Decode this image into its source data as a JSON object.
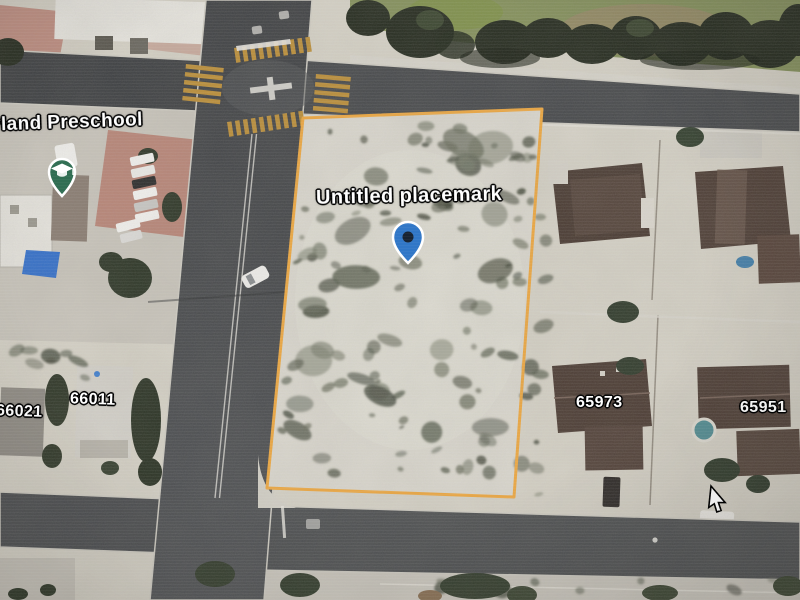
{
  "view": {
    "description": "aerial satellite view with a highlighted vacant parcel"
  },
  "labels": {
    "preschool": "yland Preschool",
    "placemark": "Untitled placemark",
    "parcels": {
      "h66021": "66021",
      "h66011": "66011",
      "h65973": "65973",
      "h65951": "65951"
    }
  },
  "icons": {
    "education_pin": "graduation-cap-pin-icon",
    "placemark_pin": "blue-placemark-pin-icon",
    "cursor": "arrow-cursor-icon"
  },
  "colors": {
    "parcel_outline": "#F1A83B",
    "placemark_blue": "#2E77CB",
    "placemark_dot": "#182434",
    "education_green": "#2E6F52",
    "road_dark": "#45474A",
    "road_light": "#4F5154",
    "desert": "#D6D2C7",
    "parcel_ground": "#DBD8CF",
    "concrete": "#CDC9C0",
    "lawn": "#85915A",
    "crosswalk": "#BF8F35",
    "roof_brown": "#4C3C34",
    "courtyard_red": "#B97E6F",
    "pool_teal": "#4F8D95",
    "tarp_blue": "#2F6FD0"
  }
}
